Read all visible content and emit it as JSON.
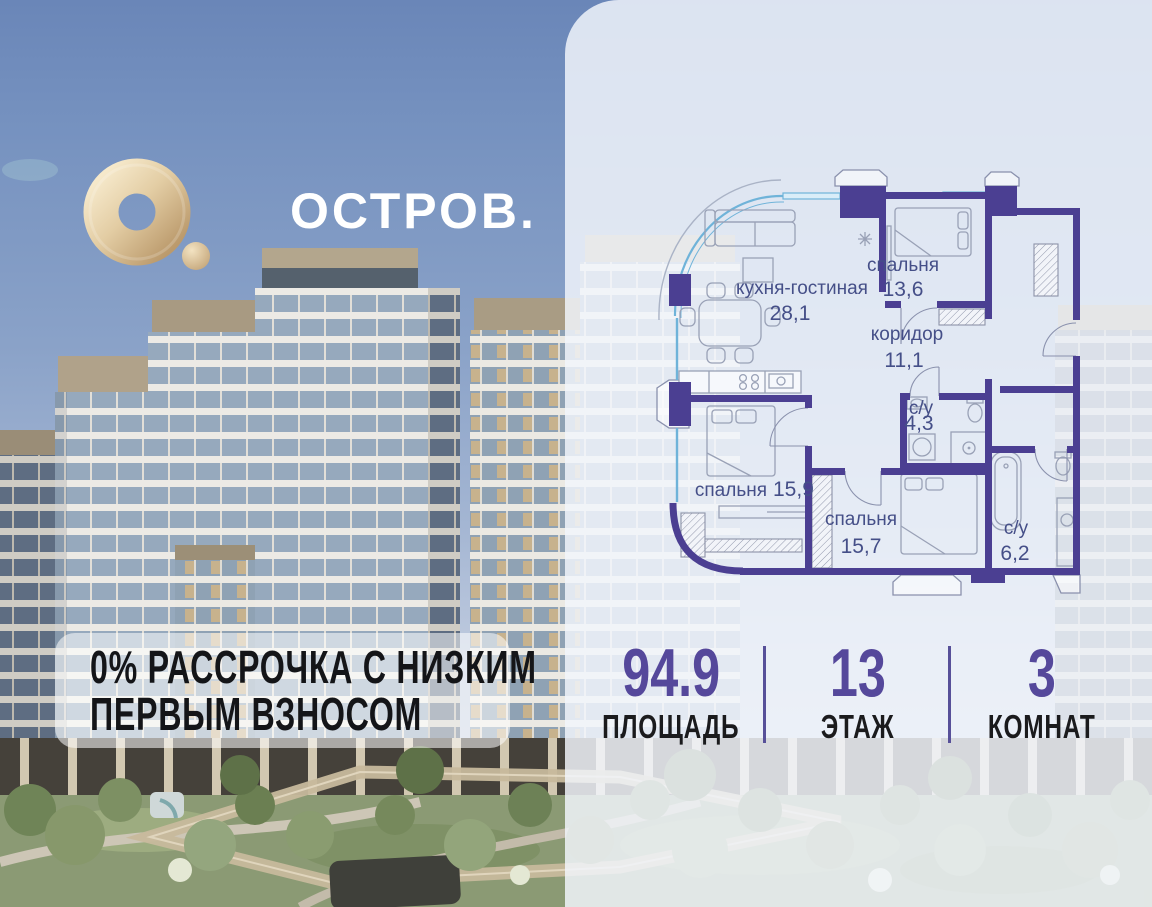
{
  "brand": {
    "logo_text": "ОСТРОВ."
  },
  "promo": {
    "line1": "0% РАССРОЧКА С НИЗКИМ",
    "line2": "ПЕРВЫМ ВЗНОСОМ"
  },
  "floorplan": {
    "rooms": [
      {
        "name": "кухня-гостиная",
        "area": "28,1"
      },
      {
        "name": "спальня",
        "area": "13,6"
      },
      {
        "name": "коридор",
        "area": "11,1"
      },
      {
        "name": "с/у",
        "area": "4,3"
      },
      {
        "name": "спальня",
        "area": "15,9"
      },
      {
        "name": "спальня",
        "area": "15,7"
      },
      {
        "name": "с/у",
        "area": "6,2"
      }
    ]
  },
  "stats": [
    {
      "value": "94.9",
      "label": "ПЛОЩАДЬ"
    },
    {
      "value": "13",
      "label": "ЭТАЖ"
    },
    {
      "value": "3",
      "label": "КОМНАТ"
    }
  ],
  "colors": {
    "accent_purple": "#55489b",
    "wall_purple": "#4b3f92",
    "plan_label_blue": "#454f88",
    "window_blue": "#6fb3d9",
    "logo_gold": "#cfae7f",
    "sky_top": "#6a86b8"
  }
}
